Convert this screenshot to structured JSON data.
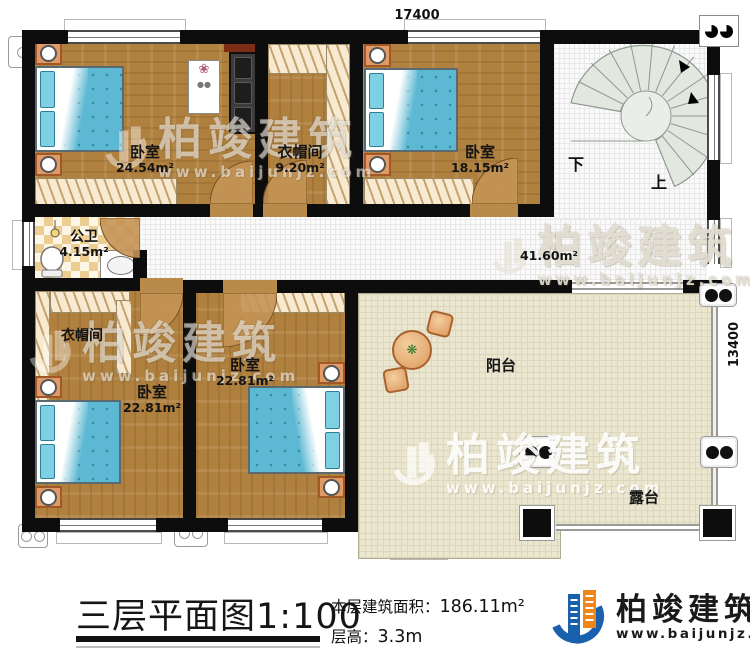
{
  "dimensions": {
    "top": "17400",
    "right": "13400"
  },
  "rooms": {
    "bedroom_tl": {
      "name": "卧室",
      "area": "24.54m²"
    },
    "cloak_top": {
      "name": "衣帽间",
      "area": "9.20m²"
    },
    "bedroom_tr": {
      "name": "卧室",
      "area": "18.15m²"
    },
    "bathroom": {
      "name": "公卫",
      "area": "4.15m²"
    },
    "hall": {
      "area": "41.60m²"
    },
    "cloak_bottom": {
      "name": "衣帽间"
    },
    "bedroom_bl": {
      "name": "卧室",
      "area": "22.81m²"
    },
    "bedroom_bm": {
      "name": "卧室",
      "area": "22.81m²"
    },
    "balcony": {
      "name": "阳台"
    },
    "terrace": {
      "name": "露台"
    }
  },
  "stairs": {
    "down": "下",
    "up": "上"
  },
  "title": {
    "text": "三层平面图",
    "scale": "1:100"
  },
  "stats": {
    "area_label": "本层建筑面积：",
    "area_value": "186.11m²",
    "height_label": "层高：",
    "height_value": "3.3m"
  },
  "brand": {
    "name": "柏竣建筑",
    "website": "www.baijunjz.com"
  },
  "watermark": {
    "name": "柏竣建筑",
    "website": "www.baijunjz.com"
  },
  "colors": {
    "wall": "#0d0d0d",
    "wood": "#b0803e",
    "terrace": "#eae6d0",
    "bed": "#5cb8d3",
    "brand_blue": "#1961ac",
    "brand_orange": "#f08519"
  }
}
